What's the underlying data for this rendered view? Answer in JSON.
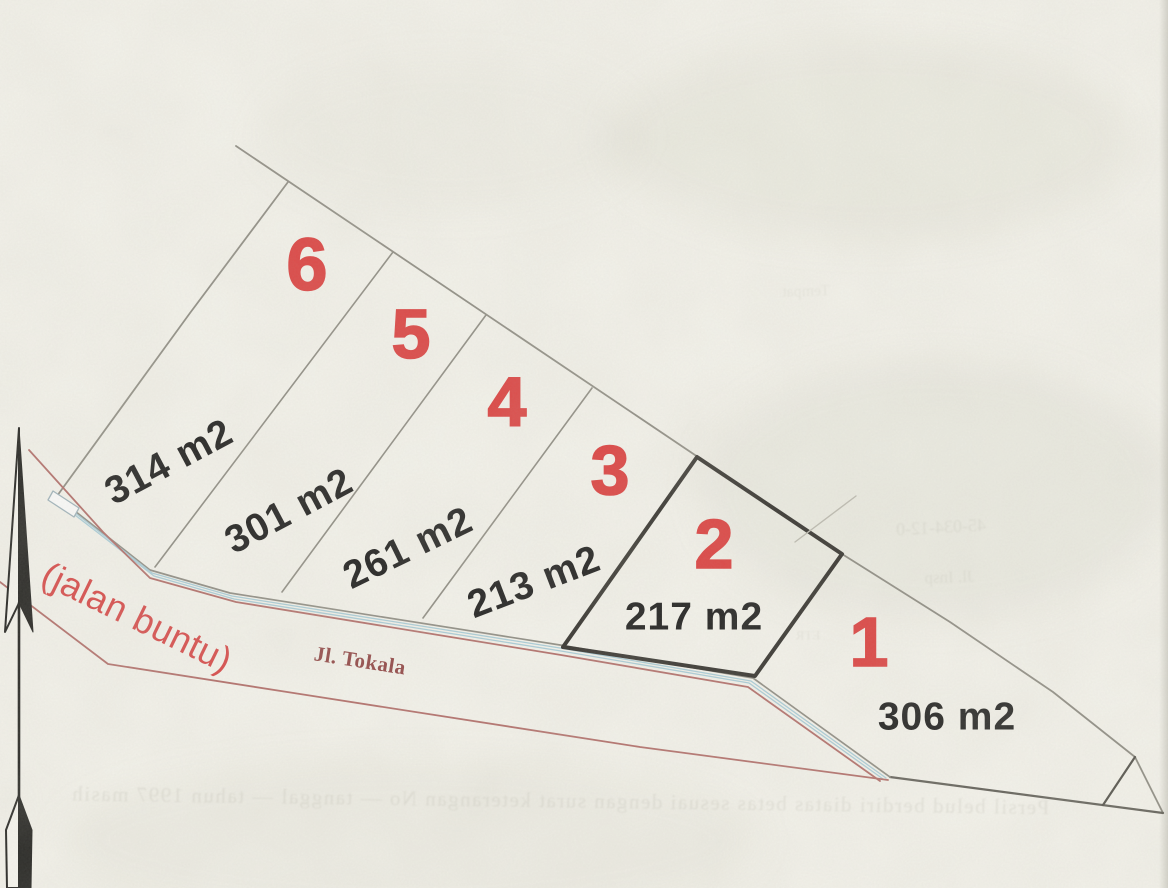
{
  "plots": [
    {
      "number": "1",
      "area_label": "306 m2"
    },
    {
      "number": "2",
      "area_label": "217 m2"
    },
    {
      "number": "3",
      "area_label": "213 m2"
    },
    {
      "number": "4",
      "area_label": "261 m2"
    },
    {
      "number": "5",
      "area_label": "301 m2"
    },
    {
      "number": "6",
      "area_label": "314 m2"
    }
  ],
  "road": {
    "name": "Jl. Tokala",
    "dead_end_note": "(jalan buntu)"
  },
  "compass": {
    "type": "north-arrow"
  },
  "colors": {
    "paper": "#f7f6ef",
    "plot_number_red": "#de3a3a",
    "dead_end_note_red": "#d94343",
    "road_name_maroon": "#8f4040",
    "area_label_black": "#161616",
    "boundary_gray": "#8d8b82",
    "road_edge_red": "#b26b67",
    "water_line_blue": "#a8cedb",
    "highlighted_plot_outline": "#2d2b27"
  },
  "bleedthrough_texts": {
    "bottom_line": "Persil belud berdiri diatas betas sesuai dengan surat keterangan No — tanggal — tahun 1997 masih",
    "right_1": "45-034-12-0",
    "right_2": "Jl. Insp",
    "right_3": "ETR",
    "upper_right": "Tempat"
  }
}
